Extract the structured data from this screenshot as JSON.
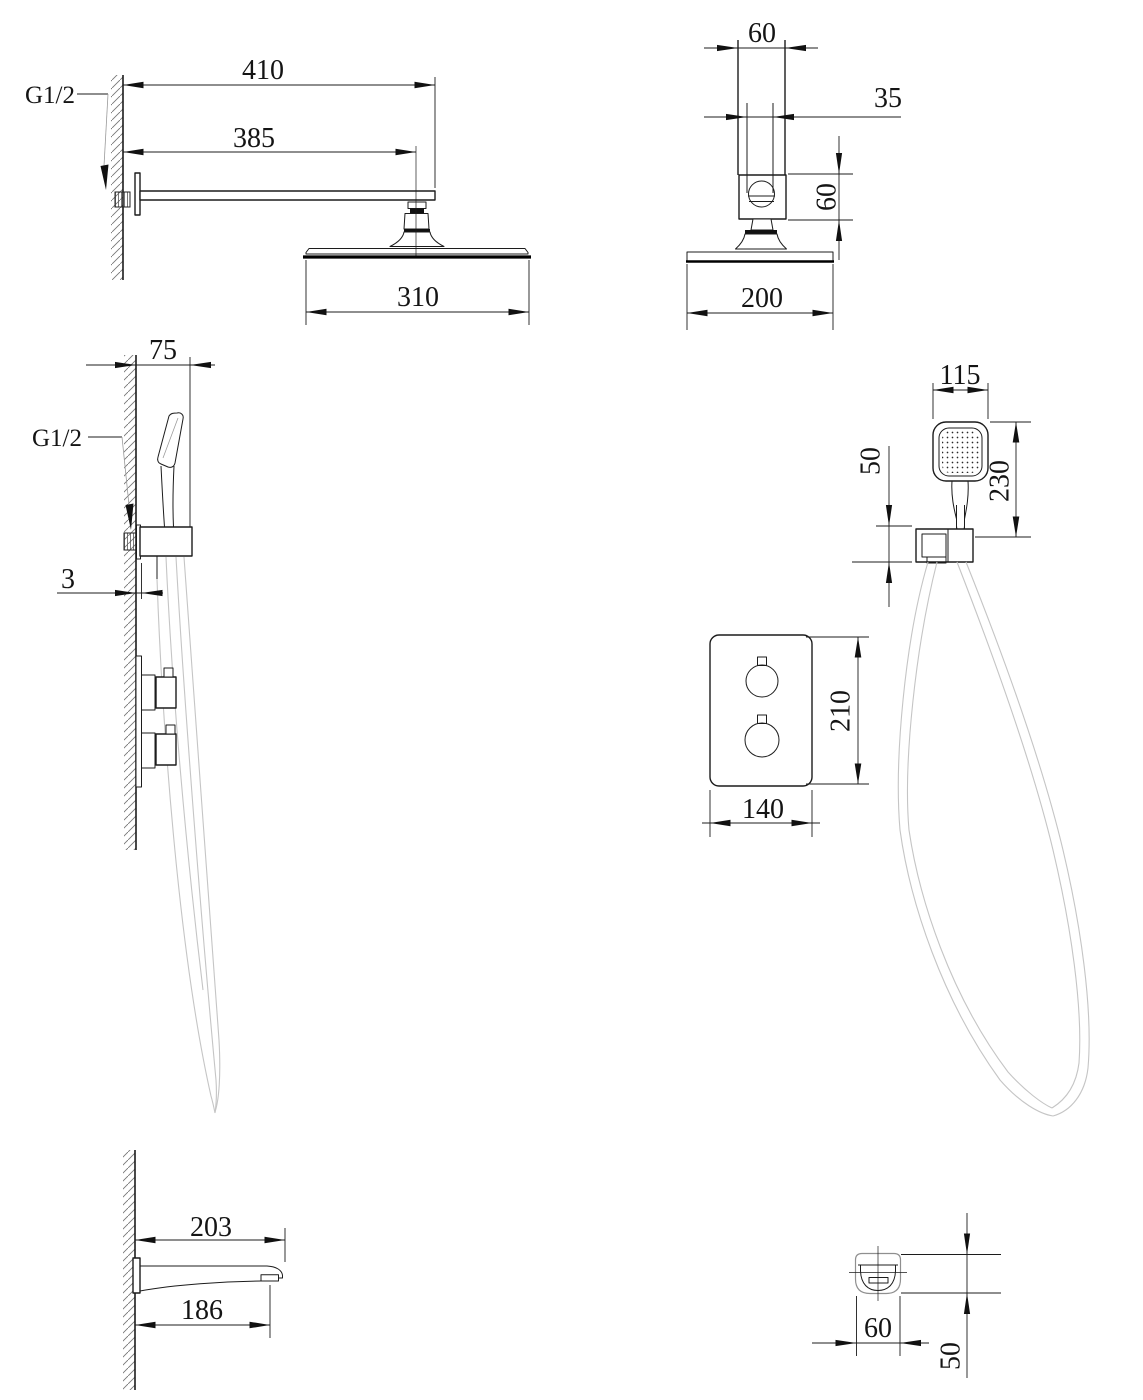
{
  "labels": {
    "thread": "G1/2"
  },
  "views": {
    "rain_side": {
      "arm_length": "410",
      "arm_to_center": "385",
      "head_diameter": "310"
    },
    "rain_front": {
      "arm_width": "60",
      "connector_width": "35",
      "connector_height": "60",
      "head_diameter": "200"
    },
    "hand_side": {
      "holder_depth": "75",
      "plate_thickness": "3"
    },
    "hand_front": {
      "head_width": "115",
      "holder_height": "50",
      "shower_length": "230"
    },
    "valve": {
      "plate_height": "210",
      "plate_width": "140"
    },
    "spout_side": {
      "length_total": "203",
      "length_to_outlet": "186"
    },
    "spout_front": {
      "width": "60",
      "height": "50"
    }
  }
}
